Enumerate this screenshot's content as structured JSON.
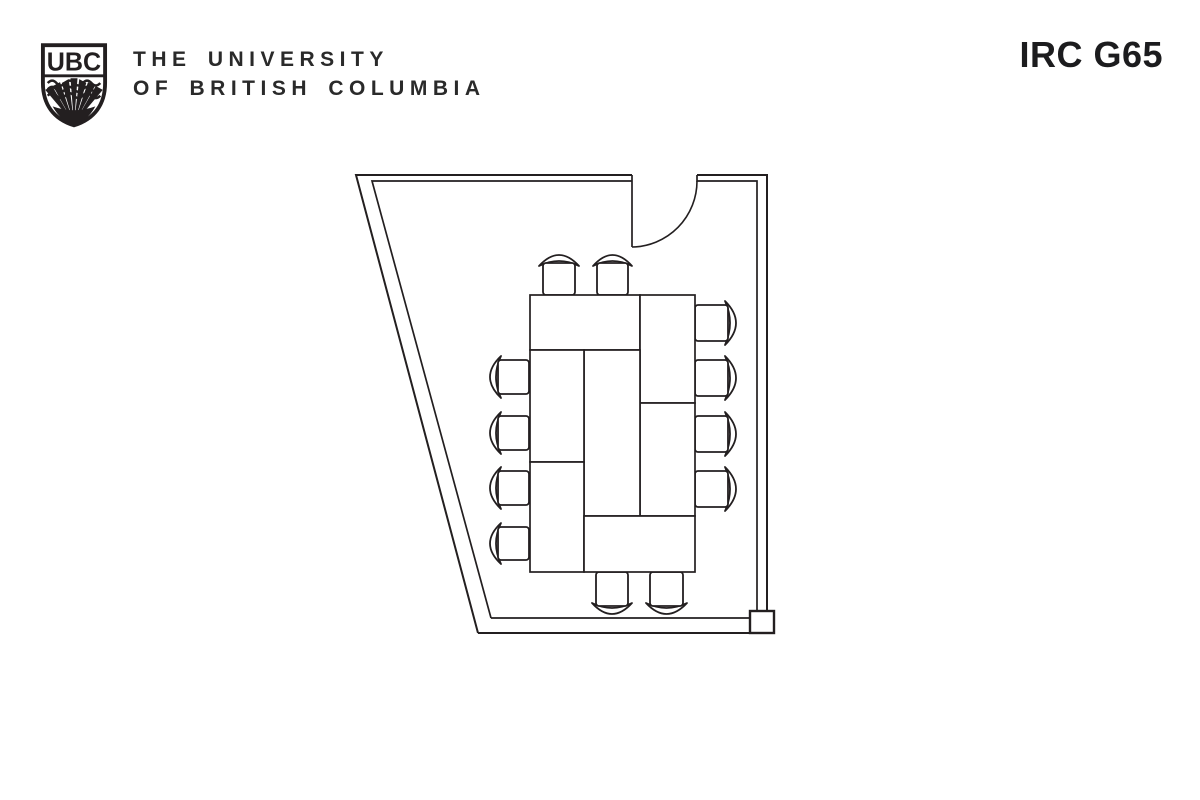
{
  "header": {
    "logo_text": "UBC",
    "institution": [
      "THE UNIVERSITY",
      "OF BRITISH COLUMBIA"
    ],
    "room_label": "IRC G65"
  },
  "colors": {
    "line": "#231f20",
    "text": "#2a2a2a",
    "background": "#ffffff"
  },
  "floor_plan": {
    "room_name": "IRC G65",
    "chair_count": 12,
    "table_segment_count": 7,
    "walls": {
      "outer": [
        [
          [
            478,
            633
          ],
          [
            356,
            175
          ],
          [
            632,
            175
          ]
        ],
        [
          [
            697,
            175
          ],
          [
            767,
            175
          ],
          [
            767,
            611
          ]
        ],
        [
          [
            478,
            633
          ],
          [
            774,
            633
          ]
        ]
      ],
      "inner": [
        [
          [
            491,
            618
          ],
          [
            372,
            181
          ],
          [
            632,
            181
          ]
        ],
        [
          [
            697,
            175
          ],
          [
            697,
            181
          ],
          [
            757,
            181
          ],
          [
            757,
            611
          ]
        ],
        [
          [
            491,
            618
          ],
          [
            750,
            618
          ]
        ]
      ],
      "end_cap": {
        "x": 750,
        "y": 611,
        "w": 24,
        "h": 22
      }
    },
    "door": {
      "leaf": [
        [
          632,
          175
        ],
        [
          632,
          247
        ]
      ],
      "arc": {
        "from": [
          632,
          247
        ],
        "to": [
          697,
          181
        ],
        "r": 66
      }
    },
    "tables": [
      {
        "x": 530,
        "y": 295,
        "w": 110,
        "h": 55
      },
      {
        "x": 640,
        "y": 295,
        "w": 55,
        "h": 108
      },
      {
        "x": 640,
        "y": 403,
        "w": 55,
        "h": 113
      },
      {
        "x": 584,
        "y": 350,
        "w": 56,
        "h": 166
      },
      {
        "x": 530,
        "y": 350,
        "w": 54,
        "h": 112
      },
      {
        "x": 530,
        "y": 462,
        "w": 54,
        "h": 110
      },
      {
        "x": 584,
        "y": 516,
        "w": 111,
        "h": 56
      }
    ],
    "chairs": [
      {
        "x": 543,
        "y": 263,
        "w": 32,
        "h": 32,
        "side": "top"
      },
      {
        "x": 597,
        "y": 263,
        "w": 31,
        "h": 32,
        "side": "top"
      },
      {
        "x": 498,
        "y": 360,
        "w": 31,
        "h": 34,
        "side": "left"
      },
      {
        "x": 498,
        "y": 416,
        "w": 31,
        "h": 34,
        "side": "left"
      },
      {
        "x": 498,
        "y": 471,
        "w": 31,
        "h": 34,
        "side": "left"
      },
      {
        "x": 498,
        "y": 527,
        "w": 31,
        "h": 33,
        "side": "left"
      },
      {
        "x": 695,
        "y": 305,
        "w": 33,
        "h": 36,
        "side": "right"
      },
      {
        "x": 695,
        "y": 360,
        "w": 33,
        "h": 36,
        "side": "right"
      },
      {
        "x": 695,
        "y": 416,
        "w": 33,
        "h": 36,
        "side": "right"
      },
      {
        "x": 695,
        "y": 471,
        "w": 33,
        "h": 36,
        "side": "right"
      },
      {
        "x": 596,
        "y": 572,
        "w": 32,
        "h": 34,
        "side": "bottom"
      },
      {
        "x": 650,
        "y": 572,
        "w": 33,
        "h": 34,
        "side": "bottom"
      }
    ]
  }
}
